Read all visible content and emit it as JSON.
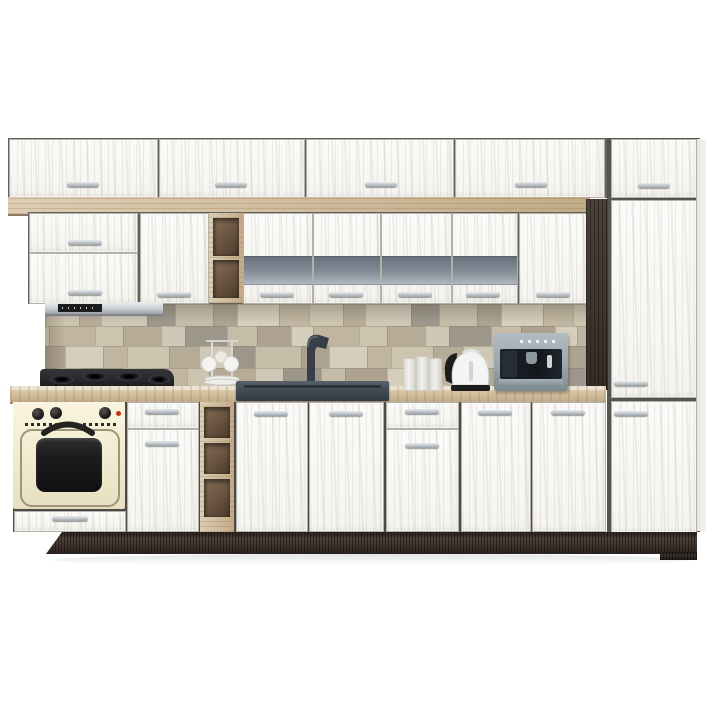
{
  "scene": {
    "label": "modular-kitchen-set-product-photo",
    "background": "#ffffff"
  },
  "palette": {
    "background": "#ffffff",
    "door_white": "#f6f5f1",
    "door_gap": "#63635d",
    "oak": "#cfba97",
    "counter": "#d9c6a5",
    "wenge": "#3e332a",
    "plinth": "#44362e",
    "glass_band": "#7e8892",
    "glass_band_light": "#b3b9c0",
    "handle_light": "#e9ecef",
    "handle_dark": "#9aa2a9",
    "hood_steel": "#c9ced2",
    "hood_black": "#1d1d1f",
    "oven_cream": "#f3edd3",
    "oven_black": "#1c1c1e",
    "oven_red": "#c23318",
    "cooktop": "#26262a",
    "sink": "#454c55",
    "appliance_steel": "#9aa6ad",
    "appliance_black": "#14181d",
    "white_item": "#f2f1ee",
    "shelf_interior": "#6e5843"
  },
  "cabinets": {
    "upper_row_door_count": 4,
    "wall_row": {
      "corner_cabinet_doors": 2,
      "single_door": 1,
      "open_shelf_cubbies": 2,
      "glass_band_doors": 4,
      "plain_door": 1
    },
    "base_row": {
      "oven_housing": 1,
      "drawer_door_cabinets": 2,
      "open_shelf_cubbies": 3,
      "sink_doors": 2,
      "plain_doors": 2
    },
    "tall_unit_doors": 3
  },
  "appliances": [
    "cooker-hood",
    "gas-cooktop",
    "retro-oven",
    "sink-with-faucet",
    "electric-kettle",
    "coffee-machine"
  ],
  "counter_items": [
    "cup-stand-with-plates",
    "canister",
    "canister",
    "canister"
  ],
  "backsplash": {
    "palette": [
      "#cdc4b0",
      "#bfb5a0",
      "#d6cebc",
      "#aca28f",
      "#c6bda9",
      "#9d978b",
      "#d0c8b6",
      "#b5ab97"
    ],
    "row_heights": [
      22,
      20,
      22,
      20
    ],
    "row_offsets": [
      0,
      -18,
      -8,
      -26
    ],
    "tile_widths": [
      34,
      22,
      46,
      28,
      38,
      24,
      42,
      30
    ]
  }
}
